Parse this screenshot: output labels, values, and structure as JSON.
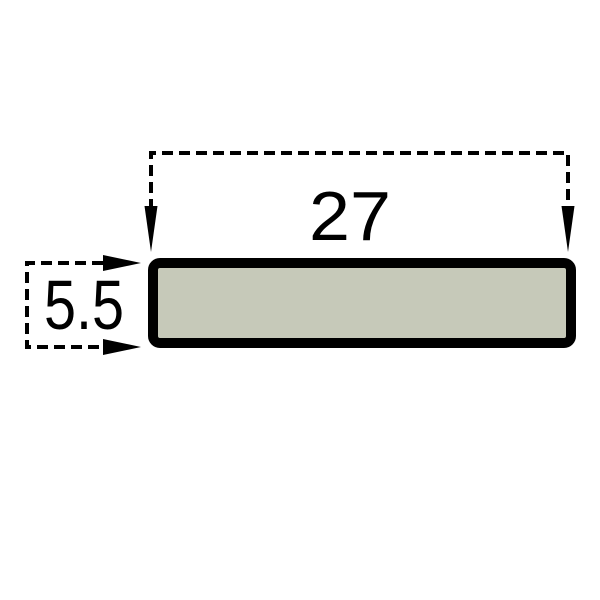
{
  "diagram": {
    "type": "technical-drawing-cross-section",
    "dimensions": {
      "width_label": "27",
      "height_label": "5.5"
    },
    "icons": {
      "width_dimension_arrows": "arrow-down",
      "height_dimension_arrows": "arrow-right"
    },
    "colors": {
      "outline": "#000000",
      "profile_fill": "#c6c9b9",
      "background": "#ffffff"
    }
  }
}
